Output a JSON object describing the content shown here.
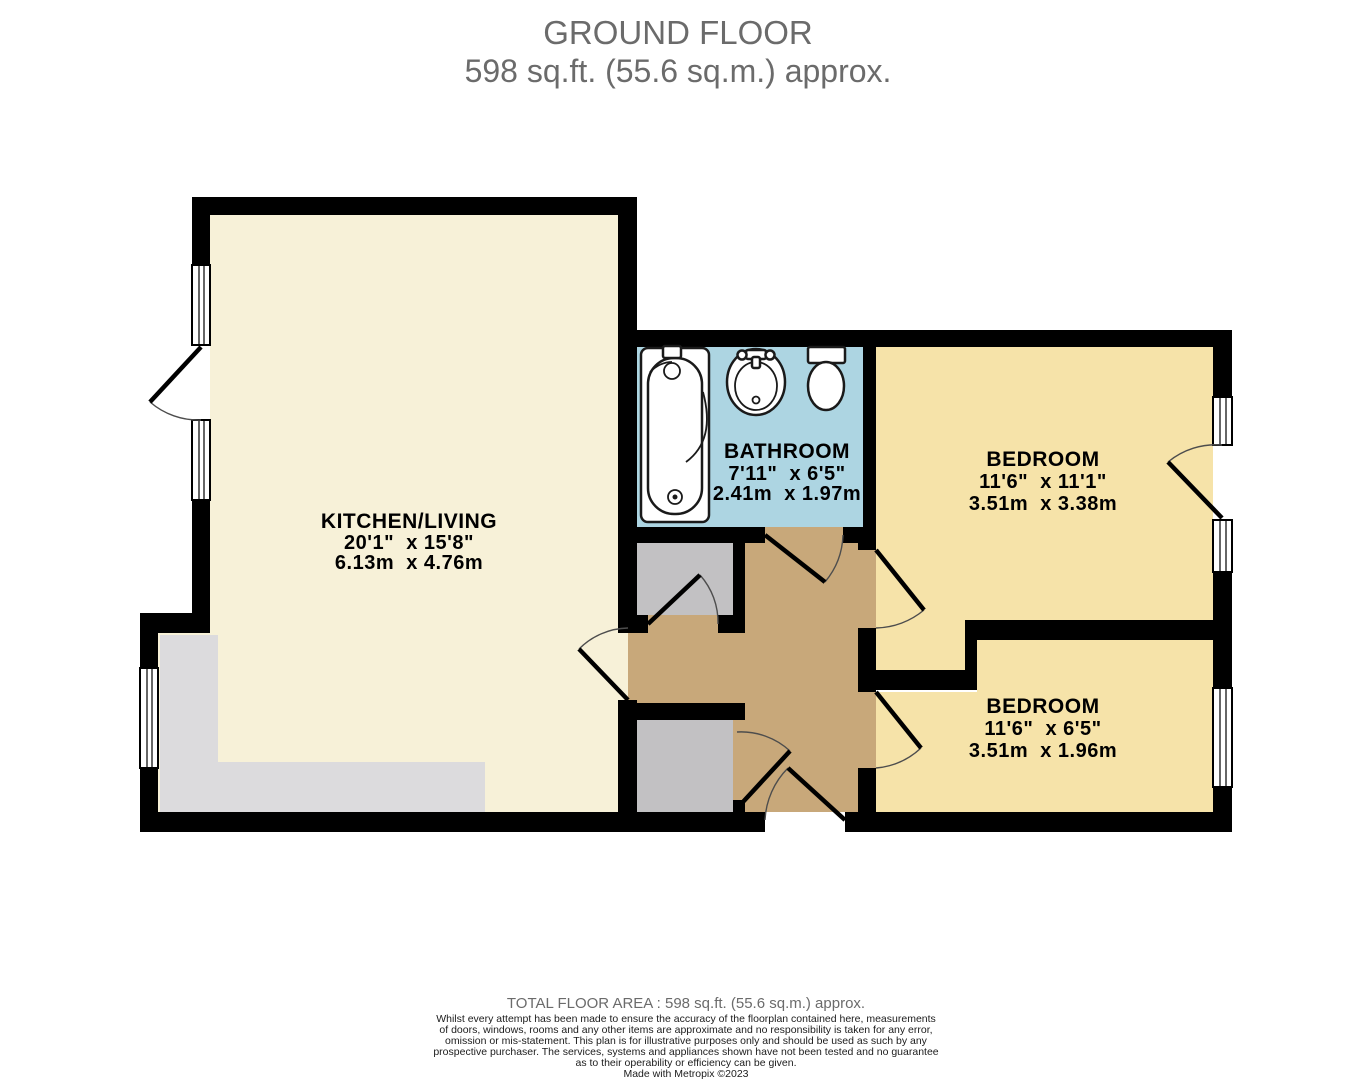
{
  "title": {
    "line1": "GROUND FLOOR",
    "line2": "598 sq.ft. (55.6 sq.m.) approx."
  },
  "rooms": [
    {
      "name": "KITCHEN/LIVING",
      "imperial": "20'1\"  x 15'8\"",
      "metric": "6.13m  x 4.76m"
    },
    {
      "name": "BATHROOM",
      "imperial": "7'11\"  x 6'5\"",
      "metric": "2.41m  x 1.97m"
    },
    {
      "name": "BEDROOM",
      "imperial": "11'6\"  x 11'1\"",
      "metric": "3.51m  x 3.38m"
    },
    {
      "name": "BEDROOM",
      "imperial": "11'6\"  x 6'5\"",
      "metric": "3.51m  x 1.96m"
    }
  ],
  "footer": {
    "total_area": "TOTAL FLOOR AREA : 598 sq.ft. (55.6 sq.m.) approx.",
    "disclaimer_lines": [
      "Whilst every attempt has been made to ensure the accuracy of the floorplan contained here, measurements",
      "of doors, windows, rooms and any other items are approximate and no responsibility is taken for any error,",
      "omission or mis-statement. This plan is for illustrative purposes only and should be used as such by any",
      "prospective purchaser. The services, systems and appliances shown have not been tested and no guarantee",
      "as to their operability or efficiency can be given."
    ],
    "credit": "Made with Metropix ©2023"
  },
  "colors": {
    "kitchen_floor": "#f7f1d8",
    "bedroom_floor": "#f6e3a9",
    "hallway_floor": "#c8a87a",
    "closet_floor": "#c2c1c3",
    "counter": "#dcdbdd",
    "bathroom_floor": "#add5e2",
    "walls": "#000000",
    "title_text": "#6b6b6b",
    "label_text": "#000000"
  }
}
